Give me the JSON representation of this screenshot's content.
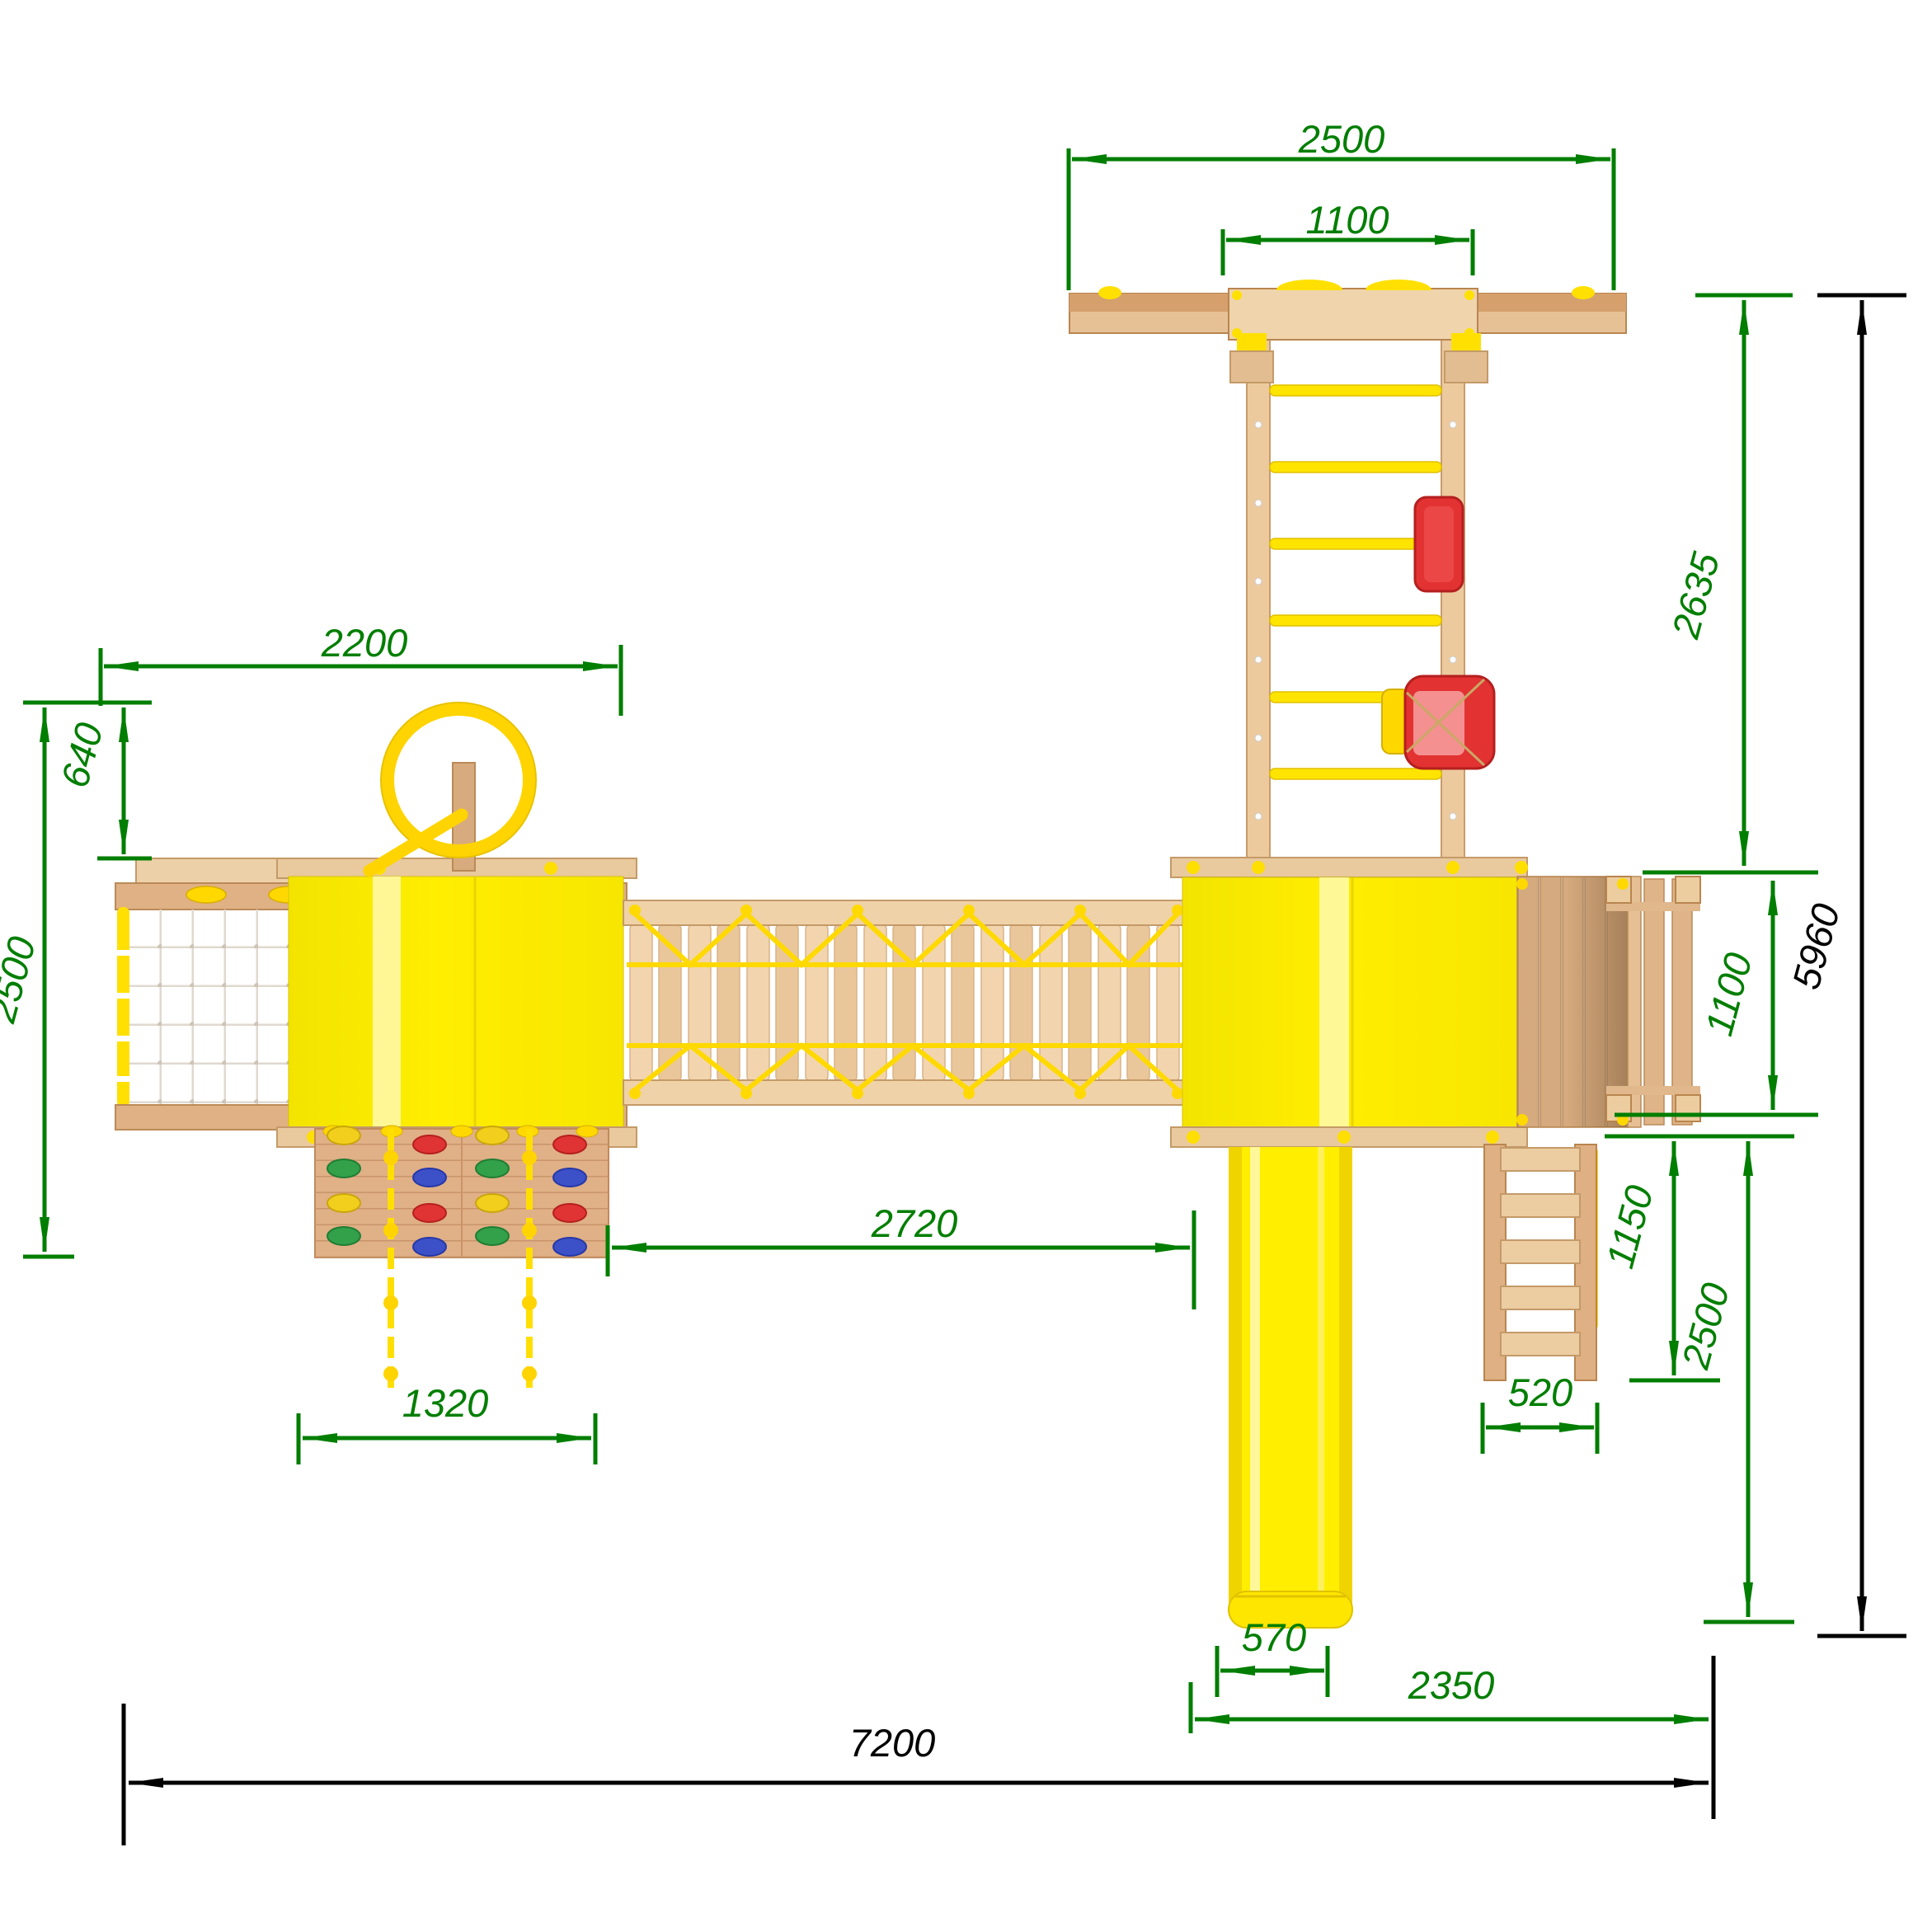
{
  "drawing": {
    "type": "technical-top-view-plan",
    "subject": "wooden playground complex with swing, rope bridge, two towers, climbing wall, net, stairs and slide",
    "units": "mm",
    "palette": {
      "dimension_green": "#007e00",
      "dimension_black": "#000000",
      "platform_yellow": "#ffee00",
      "accent_yellow": "#ffd400",
      "wood_light": "#efd2a8",
      "wood_mid": "#e3bd92",
      "wood_dark": "#cfa272",
      "seat_red": "#e23232",
      "hold_blue": "#3c50c8",
      "hold_green": "#33a04a",
      "net_white": "#e0d9cf"
    },
    "dims": {
      "swing_beam_width": "2500",
      "swing_inner_width": "1100",
      "swing_depth": "2635",
      "overall_depth": "5960",
      "left_module_width": "2200",
      "ring_offset": "640",
      "left_module_depth": "2500",
      "balcony_depth": "1100",
      "bridge_span": "2720",
      "climb_wall_width": "1320",
      "stairs_run": "1150",
      "right_module_depth": "2500",
      "stairs_width": "520",
      "slide_width": "570",
      "right_module_width": "2350",
      "overall_width": "7200"
    }
  }
}
